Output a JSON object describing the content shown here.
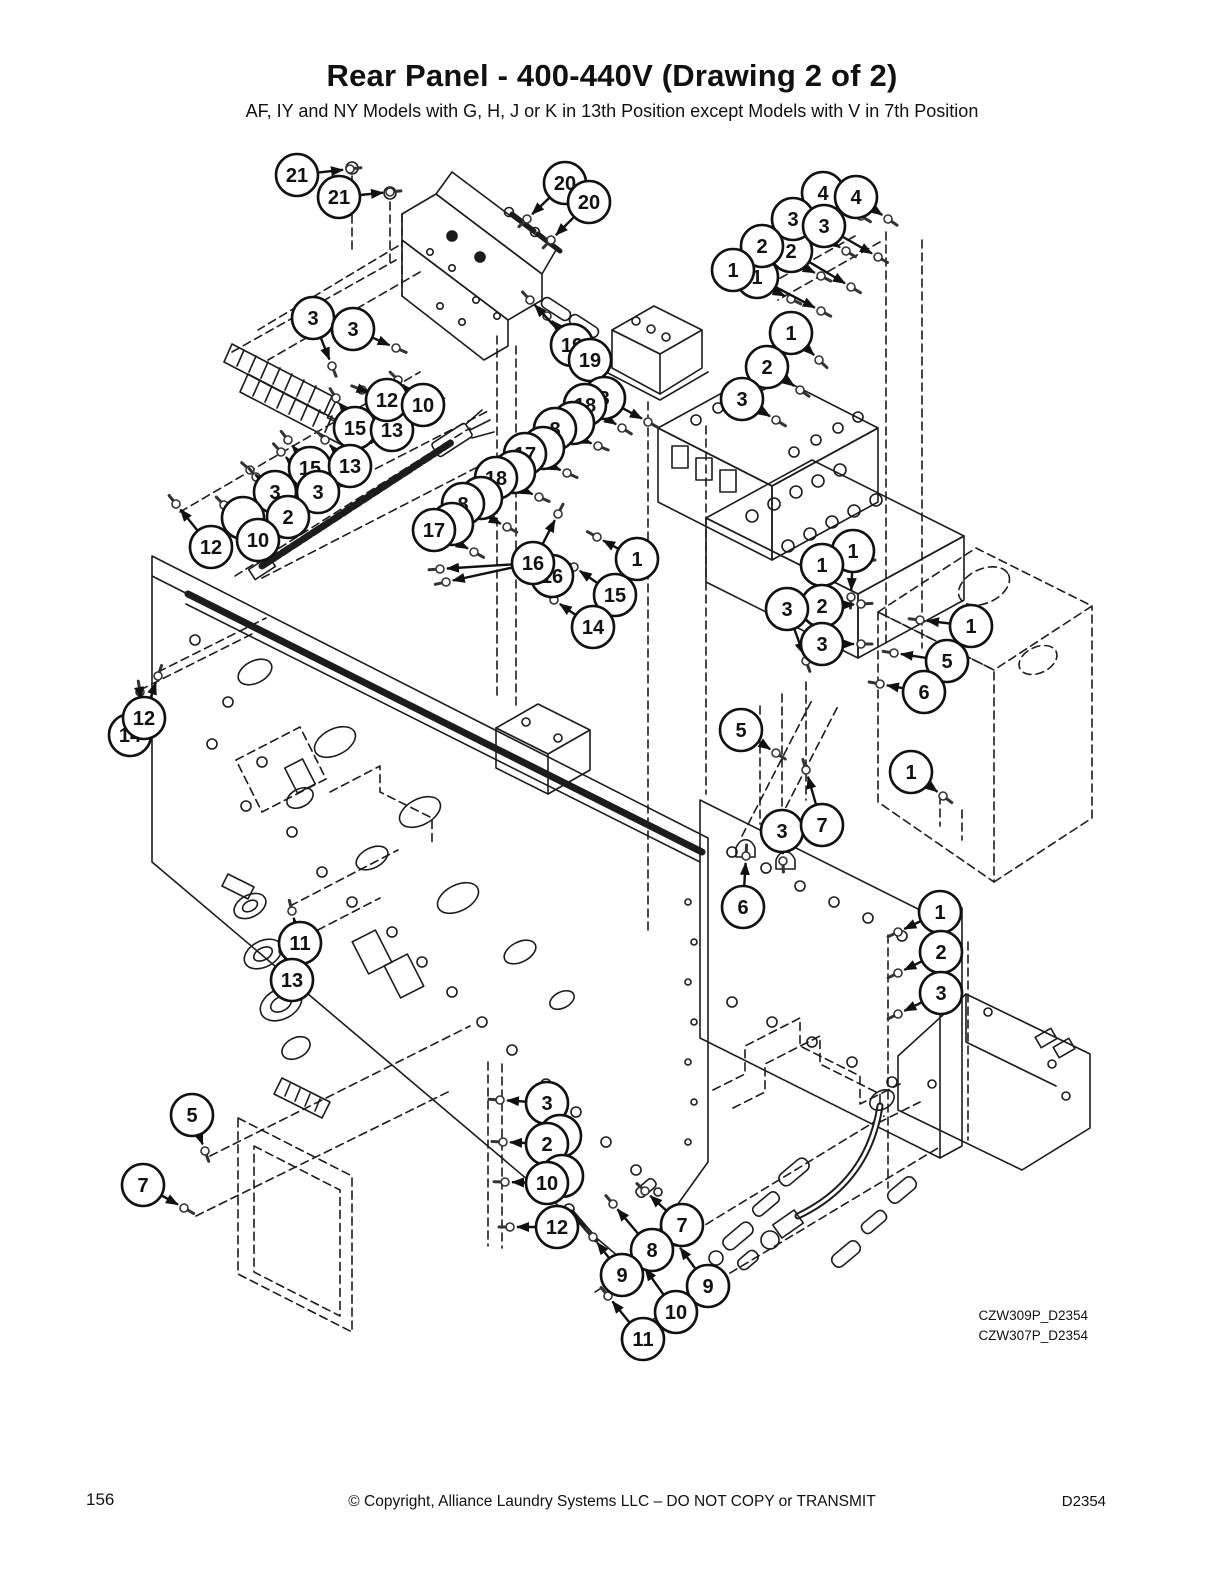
{
  "page": {
    "title": "Rear Panel - 400-440V (Drawing 2 of 2)",
    "subtitle": "AF, IY and NY Models with G, H, J or K in 13th Position except Models with V in 7th Position",
    "page_number": "156",
    "copyright": "© Copyright, Alliance Laundry Systems LLC – DO NOT COPY or TRANSMIT",
    "doc_number": "D2354",
    "drawing_refs": [
      "CZW309P_D2354",
      "CZW307P_D2354"
    ]
  },
  "callouts": [
    {
      "n": "21",
      "x": 297,
      "y": 175,
      "a": [
        [
          350,
          169
        ]
      ]
    },
    {
      "n": "21",
      "x": 339,
      "y": 197,
      "a": [
        [
          390,
          192
        ]
      ]
    },
    {
      "n": "20",
      "x": 565,
      "y": 183,
      "a": [
        [
          527,
          219
        ]
      ]
    },
    {
      "n": "20",
      "x": 589,
      "y": 202,
      "a": [
        [
          551,
          240
        ]
      ]
    },
    {
      "n": "2",
      "x": 791,
      "y": 251,
      "partial": true,
      "a": [
        [
          851,
          287
        ]
      ]
    },
    {
      "n": "1",
      "x": 757,
      "y": 277,
      "partial": true,
      "a": [
        [
          821,
          311
        ]
      ]
    },
    {
      "n": "4",
      "x": 823,
      "y": 193,
      "a": [
        [
          861,
          216
        ]
      ]
    },
    {
      "n": "4",
      "x": 856,
      "y": 197,
      "a": [
        [
          888,
          219
        ]
      ]
    },
    {
      "n": "3",
      "x": 793,
      "y": 219,
      "a": [
        [
          846,
          251
        ]
      ]
    },
    {
      "n": "3",
      "x": 824,
      "y": 226,
      "a": [
        [
          878,
          257
        ]
      ]
    },
    {
      "n": "2",
      "x": 762,
      "y": 246,
      "a": [
        [
          821,
          276
        ]
      ]
    },
    {
      "n": "1",
      "x": 733,
      "y": 270,
      "a": [
        [
          791,
          299
        ]
      ]
    },
    {
      "n": "1",
      "x": 791,
      "y": 333,
      "a": [
        [
          819,
          360
        ]
      ]
    },
    {
      "n": "2",
      "x": 767,
      "y": 367,
      "a": [
        [
          800,
          390
        ]
      ]
    },
    {
      "n": "3",
      "x": 742,
      "y": 399,
      "a": [
        [
          776,
          420
        ]
      ]
    },
    {
      "n": "3",
      "x": 313,
      "y": 318,
      "a": [
        [
          332,
          366
        ]
      ]
    },
    {
      "n": "3",
      "x": 353,
      "y": 329,
      "a": [
        [
          396,
          348
        ]
      ]
    },
    {
      "n": "15",
      "x": 355,
      "y": 428,
      "a": [
        [
          336,
          398
        ]
      ]
    },
    {
      "n": "13",
      "x": 392,
      "y": 430,
      "a": [
        [
          371,
          398
        ]
      ]
    },
    {
      "n": "12",
      "x": 387,
      "y": 400,
      "a": [
        [
          362,
          390
        ]
      ]
    },
    {
      "n": "10",
      "x": 423,
      "y": 405,
      "a": [
        [
          398,
          380
        ]
      ]
    },
    {
      "n": "15",
      "x": 310,
      "y": 468,
      "a": [
        [
          288,
          440
        ]
      ]
    },
    {
      "n": "13",
      "x": 350,
      "y": 466,
      "a": [
        [
          325,
          440
        ]
      ]
    },
    {
      "n": "3",
      "x": 275,
      "y": 492,
      "partial": true,
      "a": [
        [
          250,
          470
        ]
      ]
    },
    {
      "n": "3",
      "x": 318,
      "y": 492,
      "a": [
        [
          281,
          452
        ]
      ]
    },
    {
      "n": "",
      "x": 243,
      "y": 518,
      "partial": true
    },
    {
      "n": "2",
      "x": 288,
      "y": 517,
      "a": [
        [
          256,
          477
        ]
      ]
    },
    {
      "n": "10",
      "x": 258,
      "y": 540,
      "a": [
        [
          224,
          505
        ]
      ]
    },
    {
      "n": "12",
      "x": 211,
      "y": 547,
      "a": [
        [
          176,
          504
        ]
      ]
    },
    {
      "n": "14",
      "x": 130,
      "y": 735,
      "partial": true
    },
    {
      "n": "12",
      "x": 144,
      "y": 718,
      "a": [
        [
          140,
          692
        ],
        [
          158,
          676
        ]
      ]
    },
    {
      "n": "19",
      "x": 572,
      "y": 345,
      "partial": true,
      "a": [
        [
          530,
          300
        ]
      ]
    },
    {
      "n": "19",
      "x": 590,
      "y": 360,
      "a": [
        [
          547,
          316
        ]
      ]
    },
    {
      "n": "8",
      "x": 604,
      "y": 398,
      "a": [
        [
          648,
          422
        ]
      ]
    },
    {
      "n": "18",
      "x": 585,
      "y": 405,
      "a": [
        [
          622,
          428
        ]
      ]
    },
    {
      "n": "",
      "x": 573,
      "y": 423,
      "partial": true
    },
    {
      "n": "8",
      "x": 555,
      "y": 429,
      "a": [
        [
          598,
          446
        ]
      ]
    },
    {
      "n": "",
      "x": 543,
      "y": 448,
      "partial": true
    },
    {
      "n": "17",
      "x": 525,
      "y": 454,
      "a": [
        [
          567,
          473
        ]
      ]
    },
    {
      "n": "",
      "x": 514,
      "y": 472,
      "partial": true
    },
    {
      "n": "18",
      "x": 496,
      "y": 478,
      "a": [
        [
          539,
          497
        ]
      ]
    },
    {
      "n": "",
      "x": 481,
      "y": 498,
      "partial": true
    },
    {
      "n": "8",
      "x": 463,
      "y": 504,
      "a": [
        [
          507,
          527
        ]
      ]
    },
    {
      "n": "",
      "x": 452,
      "y": 524,
      "partial": true
    },
    {
      "n": "17",
      "x": 434,
      "y": 530,
      "a": [
        [
          474,
          552
        ]
      ]
    },
    {
      "n": "16",
      "x": 552,
      "y": 576,
      "partial": true
    },
    {
      "n": "16",
      "x": 533,
      "y": 563,
      "a": [
        [
          558,
          514
        ],
        [
          440,
          569
        ],
        [
          446,
          582
        ]
      ]
    },
    {
      "n": "1",
      "x": 637,
      "y": 559,
      "a": [
        [
          597,
          537
        ]
      ]
    },
    {
      "n": "15",
      "x": 615,
      "y": 595,
      "a": [
        [
          574,
          567
        ]
      ]
    },
    {
      "n": "14",
      "x": 593,
      "y": 627,
      "a": [
        [
          554,
          600
        ]
      ]
    },
    {
      "n": "1",
      "x": 853,
      "y": 551,
      "a": [
        [
          851,
          597
        ]
      ]
    },
    {
      "n": "1",
      "x": 822,
      "y": 565,
      "a": [
        [
          864,
          561
        ]
      ]
    },
    {
      "n": "2",
      "x": 822,
      "y": 606,
      "a": [
        [
          861,
          604
        ]
      ]
    },
    {
      "n": "3",
      "x": 787,
      "y": 609,
      "a": [
        [
          806,
          661
        ]
      ]
    },
    {
      "n": "3",
      "x": 822,
      "y": 644,
      "a": [
        [
          861,
          644
        ]
      ]
    },
    {
      "n": "1",
      "x": 971,
      "y": 626,
      "a": [
        [
          920,
          620
        ]
      ]
    },
    {
      "n": "5",
      "x": 947,
      "y": 661,
      "a": [
        [
          894,
          653
        ]
      ]
    },
    {
      "n": "6",
      "x": 924,
      "y": 692,
      "a": [
        [
          880,
          684
        ]
      ]
    },
    {
      "n": "5",
      "x": 741,
      "y": 730,
      "a": [
        [
          776,
          753
        ]
      ]
    },
    {
      "n": "1",
      "x": 911,
      "y": 772,
      "a": [
        [
          943,
          796
        ]
      ]
    },
    {
      "n": "3",
      "x": 782,
      "y": 831,
      "a": [
        [
          783,
          861
        ]
      ]
    },
    {
      "n": "7",
      "x": 822,
      "y": 825,
      "a": [
        [
          806,
          770
        ]
      ]
    },
    {
      "n": "6",
      "x": 743,
      "y": 907,
      "a": [
        [
          746,
          856
        ]
      ]
    },
    {
      "n": "1",
      "x": 940,
      "y": 912,
      "a": [
        [
          898,
          932
        ]
      ]
    },
    {
      "n": "2",
      "x": 941,
      "y": 952,
      "a": [
        [
          898,
          973
        ]
      ]
    },
    {
      "n": "3",
      "x": 941,
      "y": 993,
      "a": [
        [
          898,
          1014
        ]
      ]
    },
    {
      "n": "11",
      "x": 300,
      "y": 943,
      "a": [
        [
          292,
          911
        ]
      ]
    },
    {
      "n": "13",
      "x": 292,
      "y": 980,
      "a": [
        [
          283,
          951
        ]
      ]
    },
    {
      "n": "5",
      "x": 192,
      "y": 1115,
      "a": [
        [
          205,
          1151
        ]
      ]
    },
    {
      "n": "7",
      "x": 143,
      "y": 1185,
      "a": [
        [
          184,
          1208
        ]
      ]
    },
    {
      "n": "3",
      "x": 547,
      "y": 1103,
      "a": [
        [
          500,
          1100
        ]
      ]
    },
    {
      "n": "",
      "x": 560,
      "y": 1136,
      "partial": true
    },
    {
      "n": "2",
      "x": 547,
      "y": 1144,
      "a": [
        [
          503,
          1142
        ]
      ]
    },
    {
      "n": "",
      "x": 562,
      "y": 1176,
      "partial": true
    },
    {
      "n": "10",
      "x": 547,
      "y": 1183,
      "a": [
        [
          505,
          1182
        ]
      ]
    },
    {
      "n": "12",
      "x": 557,
      "y": 1227,
      "a": [
        [
          510,
          1227
        ]
      ]
    },
    {
      "n": "7",
      "x": 682,
      "y": 1225,
      "a": [
        [
          645,
          1191
        ]
      ]
    },
    {
      "n": "8",
      "x": 652,
      "y": 1250,
      "a": [
        [
          613,
          1204
        ]
      ]
    },
    {
      "n": "9",
      "x": 622,
      "y": 1275,
      "a": [
        [
          593,
          1237
        ]
      ]
    },
    {
      "n": "9",
      "x": 708,
      "y": 1286,
      "a": [
        [
          676,
          1242
        ]
      ]
    },
    {
      "n": "10",
      "x": 676,
      "y": 1312,
      "a": [
        [
          641,
          1263
        ]
      ]
    },
    {
      "n": "11",
      "x": 643,
      "y": 1339,
      "a": [
        [
          608,
          1296
        ]
      ]
    }
  ]
}
